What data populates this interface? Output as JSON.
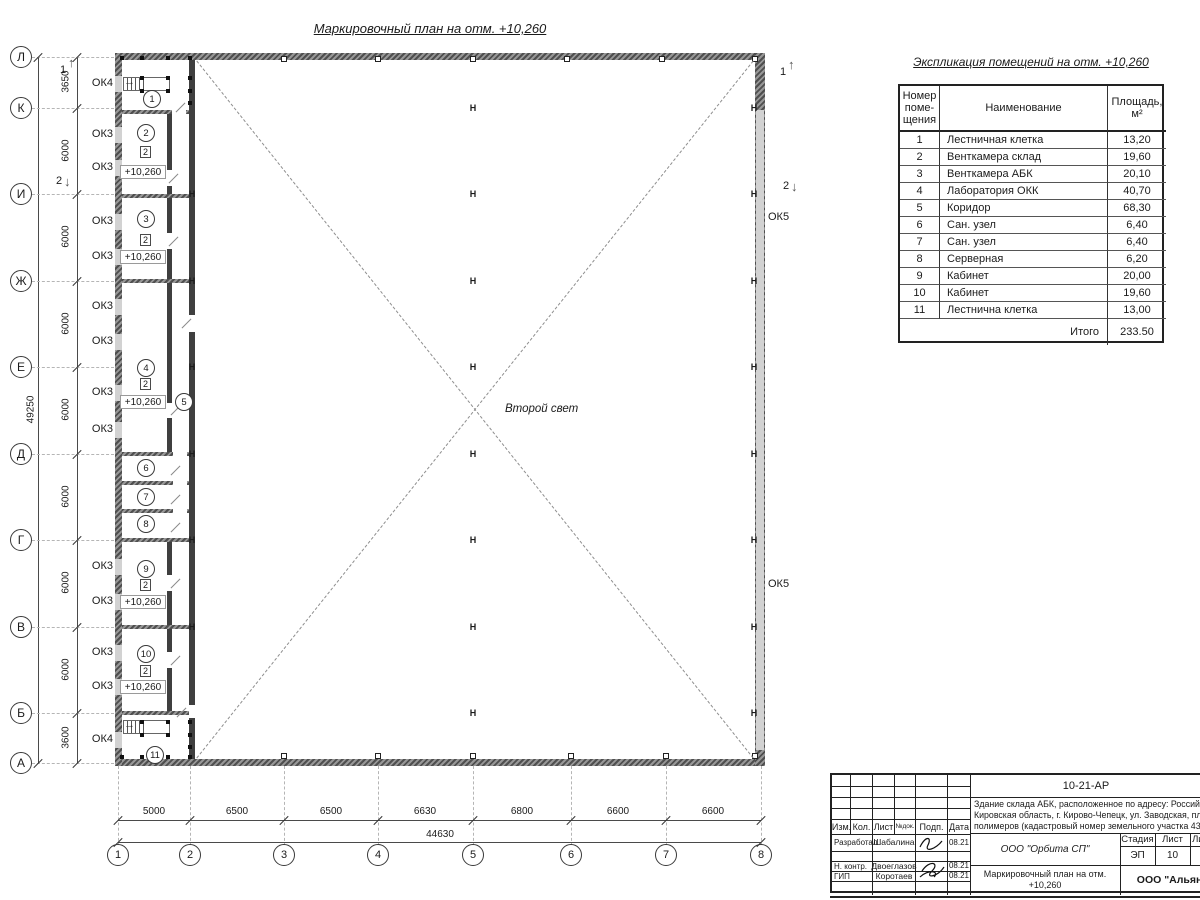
{
  "sheet": {
    "plan_title": "Маркировочный план на отм. +10,260",
    "second_light": "Второй свет"
  },
  "grid": {
    "overall_v": "49250",
    "overall_h": "44630",
    "rows": [
      {
        "label": "Л",
        "y": 57
      },
      {
        "label": "К",
        "y": 108
      },
      {
        "label": "И",
        "y": 194
      },
      {
        "label": "Ж",
        "y": 281
      },
      {
        "label": "Е",
        "y": 367
      },
      {
        "label": "Д",
        "y": 454
      },
      {
        "label": "Г",
        "y": 540
      },
      {
        "label": "В",
        "y": 627
      },
      {
        "label": "Б",
        "y": 713
      },
      {
        "label": "А",
        "y": 763
      }
    ],
    "row_dims": [
      {
        "text": "3650",
        "y": 82
      },
      {
        "text": "6000",
        "y": 151
      },
      {
        "text": "6000",
        "y": 237
      },
      {
        "text": "6000",
        "y": 324
      },
      {
        "text": "6000",
        "y": 410
      },
      {
        "text": "6000",
        "y": 497
      },
      {
        "text": "6000",
        "y": 583
      },
      {
        "text": "6000",
        "y": 670
      },
      {
        "text": "3600",
        "y": 738
      }
    ],
    "cols": [
      {
        "label": "1",
        "x": 118
      },
      {
        "label": "2",
        "x": 190
      },
      {
        "label": "3",
        "x": 284
      },
      {
        "label": "4",
        "x": 378
      },
      {
        "label": "5",
        "x": 473
      },
      {
        "label": "6",
        "x": 571
      },
      {
        "label": "7",
        "x": 666
      },
      {
        "label": "8",
        "x": 761
      }
    ],
    "col_dims": [
      {
        "text": "5000",
        "x": 154
      },
      {
        "text": "6500",
        "x": 237
      },
      {
        "text": "6500",
        "x": 331
      },
      {
        "text": "6630",
        "x": 425
      },
      {
        "text": "6800",
        "x": 522
      },
      {
        "text": "6600",
        "x": 618
      },
      {
        "text": "6600",
        "x": 713
      }
    ]
  },
  "plan": {
    "window_labels": [
      {
        "text": "ОК4",
        "y": 84
      },
      {
        "text": "ОК3",
        "y": 135
      },
      {
        "text": "ОК3",
        "y": 168
      },
      {
        "text": "ОК3",
        "y": 222
      },
      {
        "text": "ОК3",
        "y": 257
      },
      {
        "text": "ОК3",
        "y": 307
      },
      {
        "text": "ОК3",
        "y": 342
      },
      {
        "text": "ОК3",
        "y": 393
      },
      {
        "text": "ОК3",
        "y": 430
      },
      {
        "text": "ОК3",
        "y": 567
      },
      {
        "text": "ОК3",
        "y": 602
      },
      {
        "text": "ОК3",
        "y": 653
      },
      {
        "text": "ОК3",
        "y": 687
      },
      {
        "text": "ОК4",
        "y": 740
      }
    ],
    "ok5_labels": [
      {
        "text": "ОК5",
        "y": 218
      },
      {
        "text": "ОК5",
        "y": 585
      }
    ],
    "rooms": [
      {
        "num": "1",
        "x": 152,
        "y": 99
      },
      {
        "num": "2",
        "x": 146,
        "y": 133
      },
      {
        "num": "3",
        "x": 146,
        "y": 219
      },
      {
        "num": "4",
        "x": 146,
        "y": 368
      },
      {
        "num": "5",
        "x": 184,
        "y": 402
      },
      {
        "num": "6",
        "x": 146,
        "y": 468
      },
      {
        "num": "7",
        "x": 146,
        "y": 497
      },
      {
        "num": "8",
        "x": 146,
        "y": 524
      },
      {
        "num": "9",
        "x": 146,
        "y": 569
      },
      {
        "num": "10",
        "x": 146,
        "y": 654
      },
      {
        "num": "11",
        "x": 155,
        "y": 755
      }
    ],
    "unit_marks": [
      {
        "text": "2",
        "y": 152
      },
      {
        "text": "2",
        "y": 240
      },
      {
        "text": "2",
        "y": 384
      },
      {
        "text": "2",
        "y": 585
      },
      {
        "text": "2",
        "y": 671
      }
    ],
    "level_marks": [
      {
        "text": "+10,260",
        "y": 172
      },
      {
        "text": "+10,260",
        "y": 257
      },
      {
        "text": "+10,260",
        "y": 402
      },
      {
        "text": "+10,260",
        "y": 602
      },
      {
        "text": "+10,260",
        "y": 687
      }
    ],
    "section_marks": [
      {
        "num": "1",
        "x": 64,
        "y": 70,
        "dir": "up"
      },
      {
        "num": "2",
        "x": 60,
        "y": 181,
        "dir": "down"
      },
      {
        "num": "1",
        "x": 784,
        "y": 72,
        "dir": "up"
      },
      {
        "num": "2",
        "x": 787,
        "y": 186,
        "dir": "down"
      }
    ]
  },
  "explication": {
    "title": "Экспликация помещений на отм. +10,260",
    "headers": [
      "Номер\nпоме-\nщения",
      "Наименование",
      "Площадь,\nм²"
    ],
    "rows": [
      [
        "1",
        "Лестничная клетка",
        "13,20"
      ],
      [
        "2",
        "Венткамера склад",
        "19,60"
      ],
      [
        "3",
        "Венткамера АБК",
        "20,10"
      ],
      [
        "4",
        "Лаборатория ОКК",
        "40,70"
      ],
      [
        "5",
        "Коридор",
        "68,30"
      ],
      [
        "6",
        "Сан. узел",
        "6,40"
      ],
      [
        "7",
        "Сан. узел",
        "6,40"
      ],
      [
        "8",
        "Серверная",
        "6,20"
      ],
      [
        "9",
        "Кабинет",
        "20,00"
      ],
      [
        "10",
        "Кабинет",
        "19,60"
      ],
      [
        "11",
        "Лестнична клетка",
        "13,00"
      ]
    ],
    "total_label": "Итого",
    "total_value": "233.50"
  },
  "titleblock": {
    "doc_code": "10-21-АР",
    "object_desc_lines": [
      "Здание склада АБК, расположенное по адресу: Российская Феде",
      "Кировская область, г. Кирово-Чепецк, ул. Заводская, площадка з",
      "полимеров (кадастровый номер земельного участка 43:42:0000"
    ],
    "org": "ООО \"Орбита СП\"",
    "doc_title": "Маркировочный план на отм. +10,260",
    "company2": "ООО \"Альянс",
    "stage_headers": [
      "Стадия",
      "Лист",
      "Листов"
    ],
    "stage_values": [
      "ЭП",
      "10",
      "1"
    ],
    "header_cells": [
      "Изм.",
      "Кол.",
      "Лист",
      "№док.",
      "Подп.",
      "Дата"
    ],
    "roles": [
      {
        "role": "Разработал",
        "name": "Шабалина",
        "date": "08.21"
      },
      {
        "role": "Н. контр.",
        "name": "Двоеглазов",
        "date": "08.21"
      },
      {
        "role": "ГИП",
        "name": "Коротаев",
        "date": "08.21"
      }
    ]
  }
}
